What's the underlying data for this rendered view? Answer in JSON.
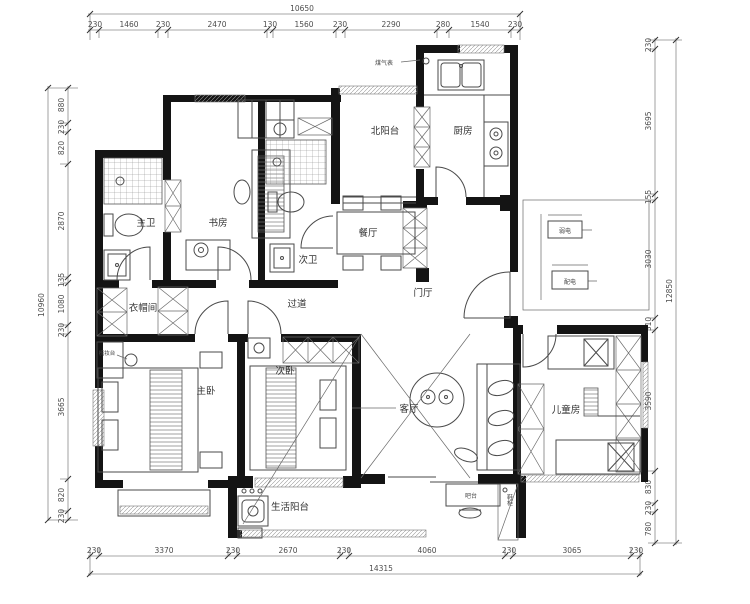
{
  "drawing": {
    "type": "apartment-floor-plan",
    "overall": {
      "top": "10650",
      "left": "10960",
      "right": "12850",
      "bottom": "14315"
    },
    "dims": {
      "top": [
        "230",
        "1460",
        "230",
        "2470",
        "130",
        "1560",
        "230",
        "2290",
        "280",
        "1540",
        "230"
      ],
      "left": [
        "880",
        "230",
        "820",
        "2870",
        "135",
        "1080",
        "230",
        "3665",
        "820",
        "230"
      ],
      "right": [
        "230",
        "3695",
        "155",
        "3030",
        "310",
        "3590",
        "830",
        "230",
        "780"
      ],
      "bottom": [
        "230",
        "3370",
        "230",
        "2670",
        "230",
        "4060",
        "230",
        "3065",
        "230"
      ]
    },
    "rooms": {
      "north_balcony": "北阳台",
      "kitchen": "厨房",
      "dining": "餐厅",
      "study": "书房",
      "master_bath": "主卫",
      "second_bath": "次卫",
      "corridor": "过道",
      "foyer": "门厅",
      "cloakroom": "衣帽间",
      "master_bedroom": "主卧",
      "second_bedroom": "次卧",
      "living": "客厅",
      "kids_room": "儿童房",
      "service_balcony": "生活阳台"
    },
    "callouts": {
      "gas_meter": "煤气表",
      "weak_current_box": "弱电",
      "power_box": "配电",
      "dresser": "梳妆台",
      "bar_counter": "吧台",
      "shoe_cabinet": "鞋柜"
    },
    "colors": {
      "wall": "#141414",
      "line": "#4a4a4a",
      "dim": "#4d4d4d",
      "background": "#ffffff"
    }
  }
}
